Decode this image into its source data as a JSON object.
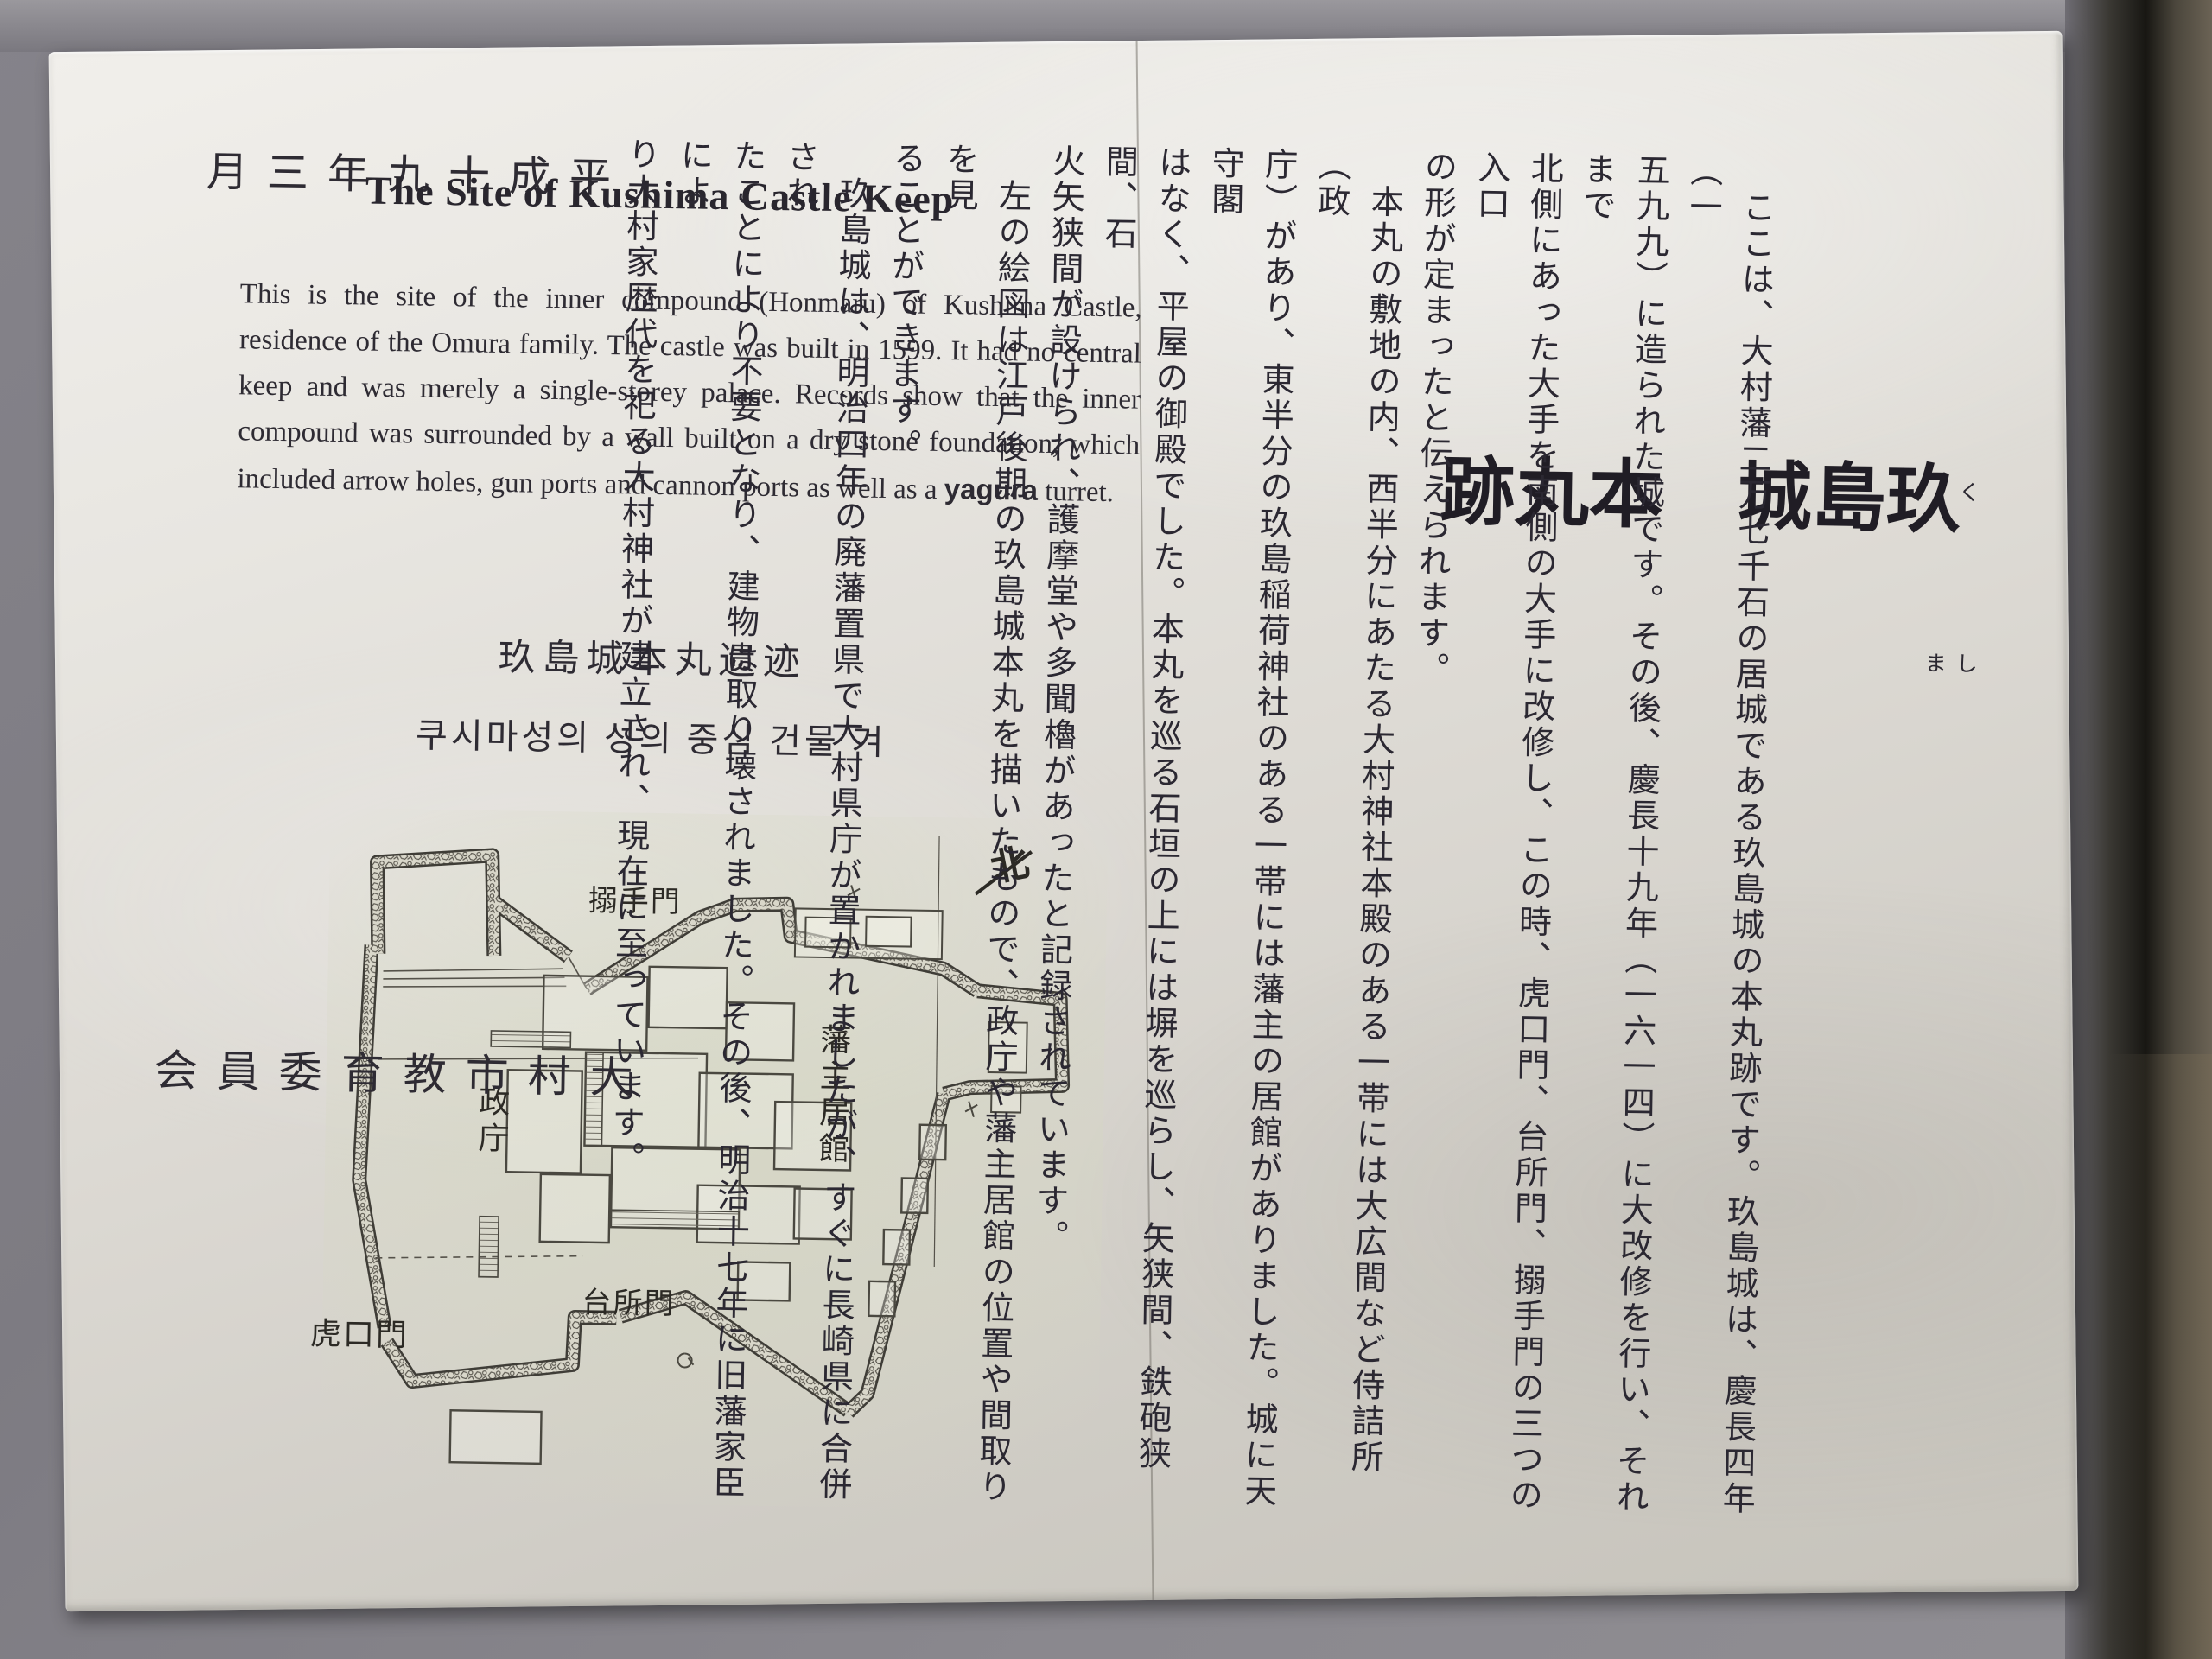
{
  "plaque": {
    "date": "平成十九年三月",
    "issuer": "大村市教育委員会",
    "english": {
      "title": "The Site of Kushima Castle Keep",
      "body_before_bold": "This is the site of the inner compound (Honmaru) of Kushima Castle, residence of the Omura family. The castle was built in 1599. It had no central keep and was merely a single-storey palace. Records show that the inner compound was surrounded by a wall built on a dry stone foundation, which included arrow holes, gun ports and cannon ports as well as a ",
      "bold_word": "yagura",
      "body_after_bold": " turret."
    },
    "chinese_title": "玖島城本丸遗迹",
    "korean_title": "쿠시마성의 성의 중심 건물 겨",
    "japanese": {
      "title_part1": "玖島城",
      "title_part2": "本丸跡",
      "title_furigana_1": "く",
      "title_furigana_2": "しま",
      "columns": [
        "　ここは、大村藩二万七千石の居城である玖島城の本丸跡です。玖島城は、慶長四年（一",
        "五九九）に造られた城です。その後、慶長十九年（一六一四）に大改修を行い、それまで",
        "北側にあった大手を南側の大手に改修し、この時、虎口門、台所門、搦手門の三つの入口",
        "の形が定まったと伝えられます。",
        "　本丸の敷地の内、西半分にあたる大村神社本殿のある一帯には大広間など侍詰所（政",
        "庁）があり、東半分の玖島稲荷神社のある一帯には藩主の居館がありました。城に天守閣",
        "はなく、平屋の御殿でした。本丸を巡る石垣の上には塀を巡らし、矢狭間、鉄砲狭間、石",
        "火矢狭間が設けられ、護摩堂や多聞櫓があったと記録されています。",
        "　左の絵図は江戸後期の玖島城本丸を描いたもので、政庁や藩主居館の位置や間取りを見",
        "ることができます。",
        "　玖島城は、明治四年の廃藩置県で大村県庁が置かれましたが、すぐに長崎県に合併され",
        "たことにより不要となり、建物は取り壊されました。その後、明治十七年に旧藩家臣によ",
        "り大村家歴代を祀る大村神社が建立され、現在に至っています。"
      ],
      "furigana_body": {
        "慶長": "けいちょう",
        "虎口": "こぐち",
        "搦手": "からめて",
        "護摩堂": "ごまどう",
        "多聞櫓": "たもんやぐら"
      }
    },
    "map_labels": {
      "north": "北",
      "gate_karamete": "搦手門",
      "seicho": "政庁",
      "hanshu_kyokan": "藩主居館",
      "gate_daidokoro": "台所門",
      "gate_koguchi": "虎口門"
    }
  }
}
